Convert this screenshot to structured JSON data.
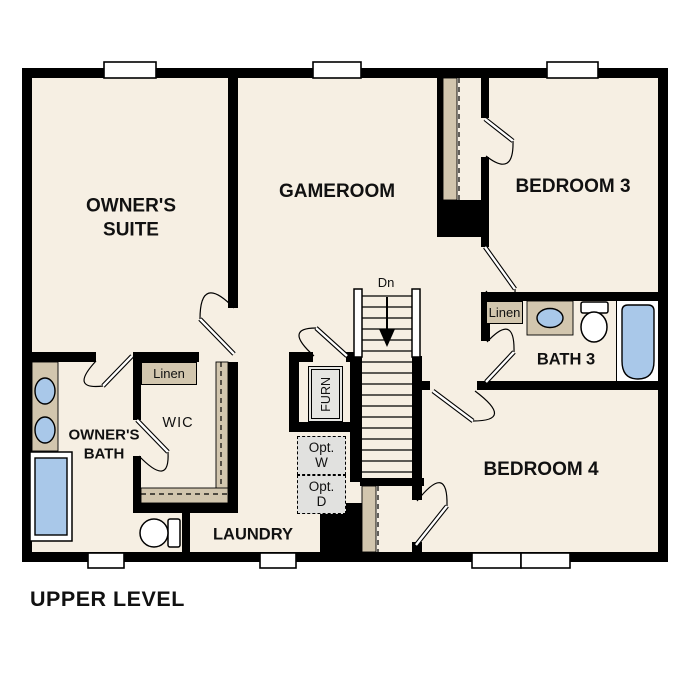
{
  "plan": {
    "title": "UPPER LEVEL",
    "rooms": {
      "owners_suite": {
        "line1": "OWNER'S",
        "line2": "SUITE"
      },
      "gameroom": {
        "label": "GAMEROOM"
      },
      "bedroom3": {
        "label": "BEDROOM 3"
      },
      "bath3": {
        "label": "BATH 3"
      },
      "bedroom4": {
        "label": "BEDROOM 4"
      },
      "owners_bath": {
        "line1": "OWNER'S",
        "line2": "BATH"
      },
      "wic": {
        "label": "WIC"
      },
      "laundry": {
        "label": "LAUNDRY"
      }
    },
    "annotations": {
      "stairs_direction": "Dn",
      "linen_closet_wic": "Linen",
      "linen_closet_bath3": "Linen",
      "furnace": "FURN",
      "optional_washer": {
        "line1": "Opt.",
        "line2": "W"
      },
      "optional_dryer": {
        "line1": "Opt.",
        "line2": "D"
      }
    },
    "colors": {
      "wall": "#000000",
      "floor": "#f6efe3",
      "shelf_tan": "#d2c6ae",
      "fixture_blue": "#a9c8e9",
      "appliance_gray": "#e6e6e3",
      "optional_gray": "#e1e1df"
    }
  }
}
